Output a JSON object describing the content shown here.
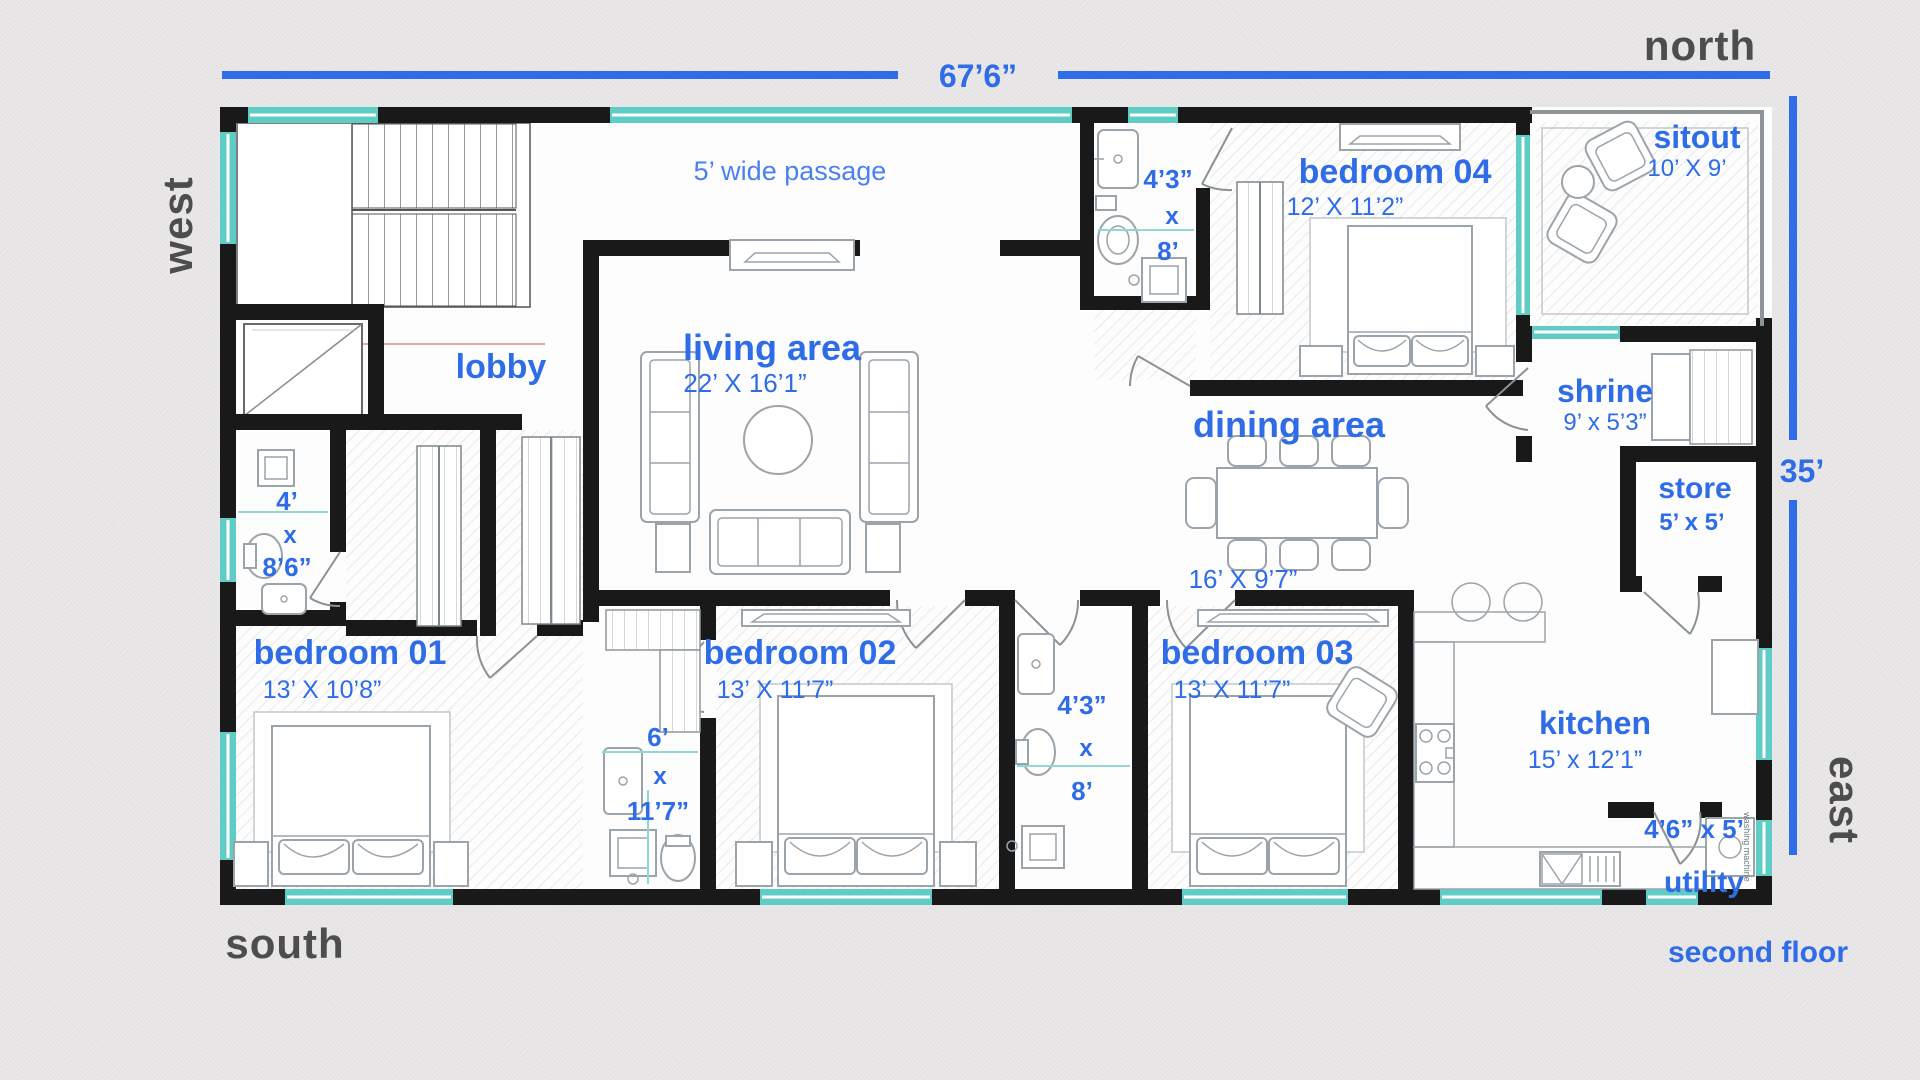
{
  "title": "second floor plan",
  "floor_label": "second floor",
  "compass": {
    "north": "north",
    "south": "south",
    "east": "east",
    "west": "west"
  },
  "overall_dimensions": {
    "width": "67’6”",
    "height": "35’"
  },
  "passage": {
    "label": "5’ wide passage"
  },
  "rooms": {
    "lobby": {
      "name": "lobby"
    },
    "living": {
      "name": "living area",
      "size": "22’ X 16’1”"
    },
    "dining": {
      "name": "dining area",
      "size": "16’ X 9’7”"
    },
    "bedroom1": {
      "name": "bedroom 01",
      "size": "13’ X 10’8”"
    },
    "bedroom2": {
      "name": "bedroom 02",
      "size": "13’ X 11’7”"
    },
    "bedroom3": {
      "name": "bedroom 03",
      "size": "13’ X 11’7”"
    },
    "bedroom4": {
      "name": "bedroom 04",
      "size": "12’ X 11’2”"
    },
    "sitout": {
      "name": "sitout",
      "size": "10’ X 9’"
    },
    "shrine": {
      "name": "shrine",
      "size": "9’ x 5’3”"
    },
    "store": {
      "name": "store",
      "size": "5’ x 5’"
    },
    "kitchen": {
      "name": "kitchen",
      "size": "15’ x 12’1”"
    },
    "utility": {
      "name": "utility",
      "size": "4’6” x 5’"
    }
  },
  "bathrooms": {
    "bath_top": {
      "w": "4’3”",
      "by": "x",
      "h": "8’"
    },
    "bath_left": {
      "w": "4’",
      "by": "x",
      "h": "8’6”"
    },
    "bath_mid": {
      "w": "6’",
      "by": "x",
      "h": "11’7”"
    },
    "bath_right": {
      "w": "4’3”",
      "by": "x",
      "h": "8’"
    }
  },
  "appliances": {
    "washing_machine": "washing machine"
  },
  "colors": {
    "label_blue": "#2e6ce8",
    "wall_black": "#191919",
    "window_teal": "#5fccc6",
    "direction_gray": "#4d4d4d",
    "background": "#eae8e9"
  }
}
